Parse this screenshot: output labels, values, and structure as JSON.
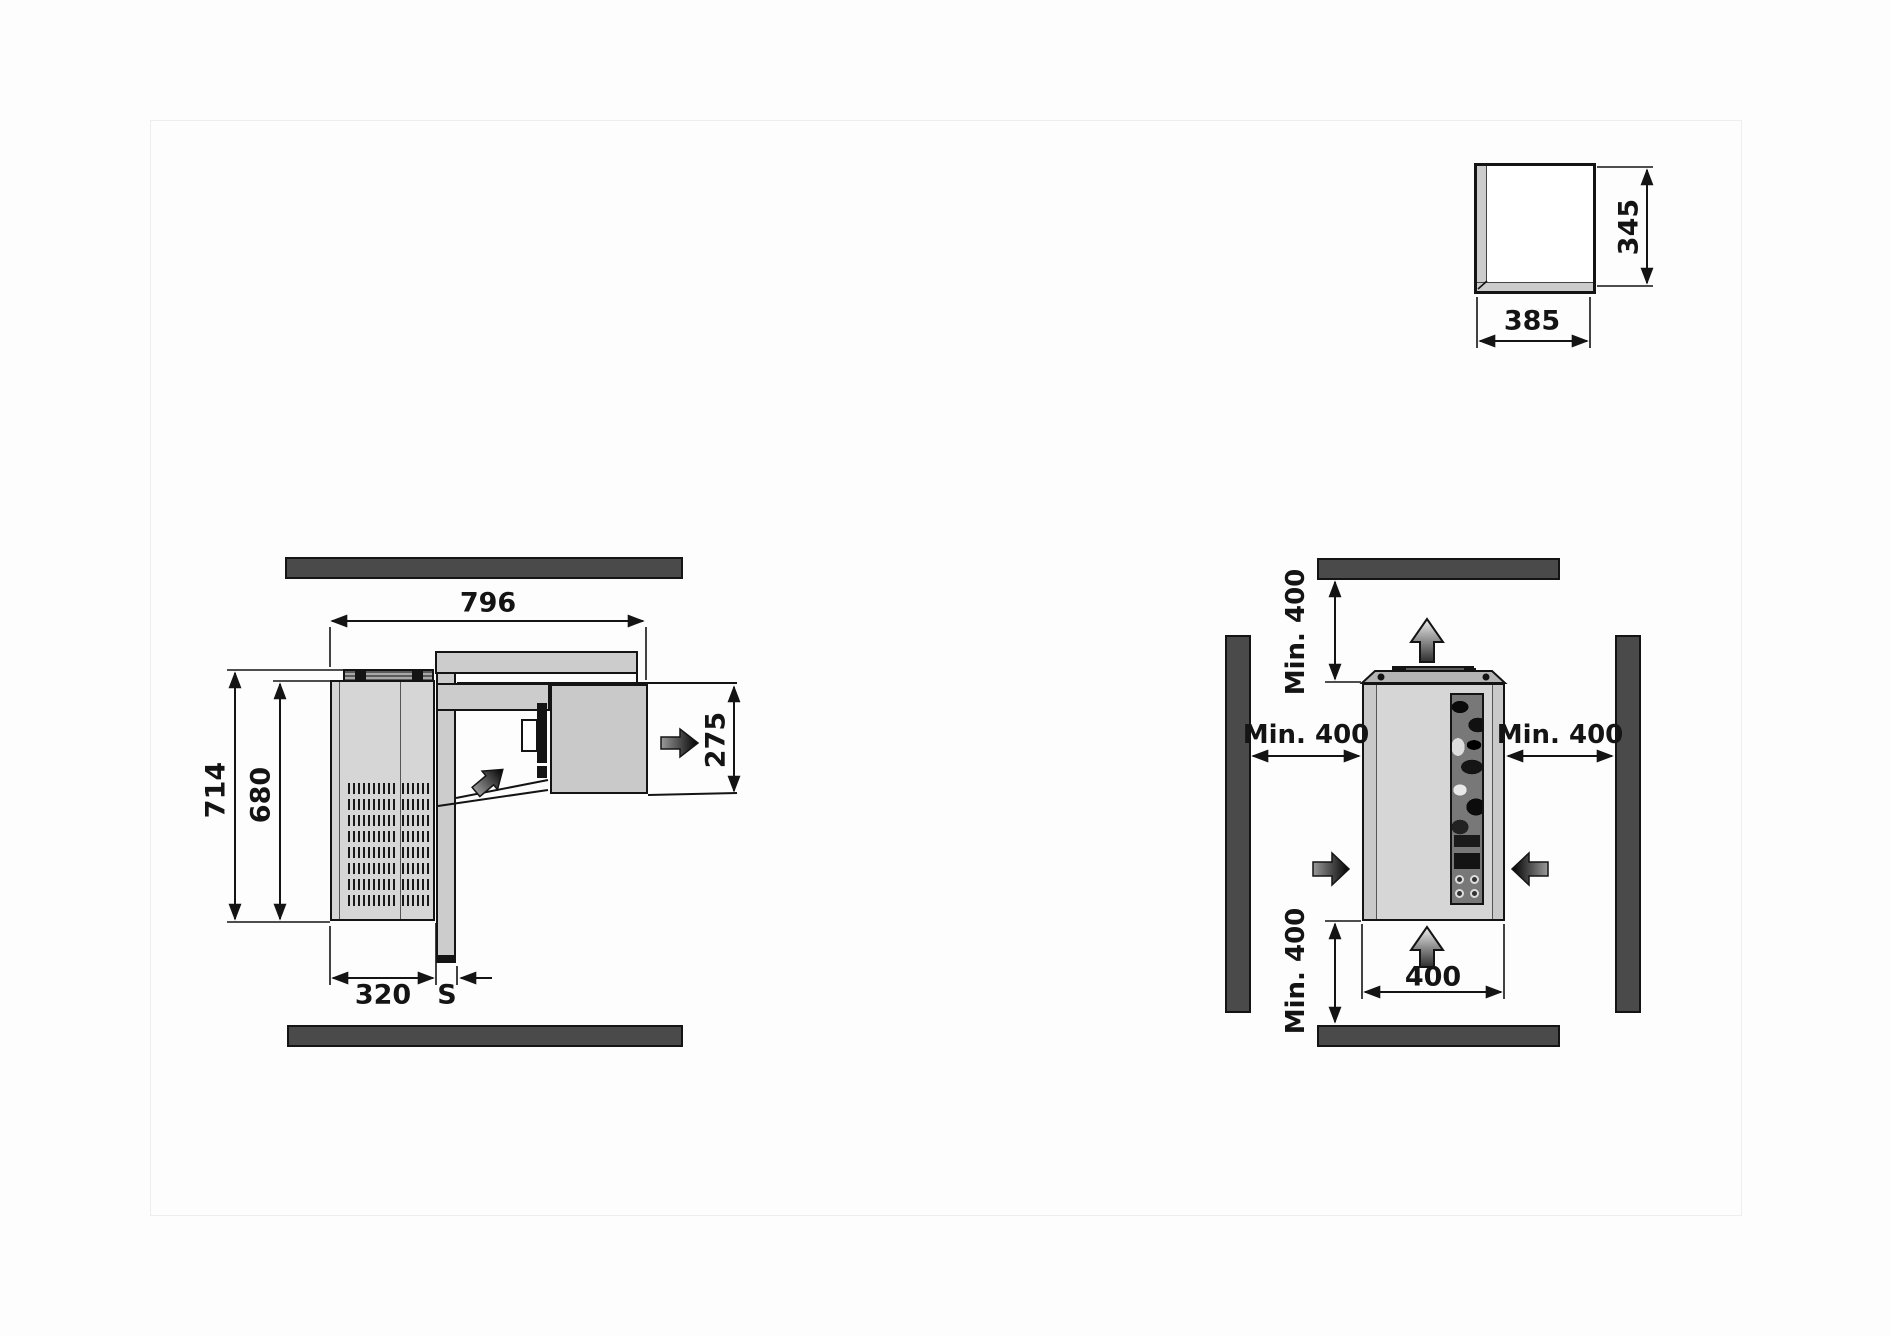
{
  "diagram_title": "monoblock-refrigeration-unit-installation-dimensions",
  "left_view": {
    "dim_width": "796",
    "dim_depth_overall": "714",
    "dim_depth_body": "680",
    "dim_external_projection": "320",
    "dim_wall_thickness": "S",
    "dim_internal_projection": "275"
  },
  "right_view": {
    "dim_clearance_top": "Min. 400",
    "dim_clearance_left": "Min. 400",
    "dim_clearance_right": "Min. 400",
    "dim_clearance_bottom": "Min. 400",
    "dim_unit_width": "400"
  },
  "niche_detail": {
    "dim_width": "385",
    "dim_height": "345"
  },
  "icons": {
    "airflow_out": "right-arrow",
    "airflow_internal": "diagonal-up-right-arrow",
    "exhaust_top": "up-arrow-outline",
    "intake_bottom": "up-arrow-outline",
    "intake_left": "right-arrow",
    "intake_right": "left-arrow"
  },
  "colors": {
    "wall_bar": "#4a4a4a",
    "line": "#141414",
    "unit_fill": "#d6d6d6",
    "panel_fill": "#cccccc",
    "background": "#fdfdfd"
  }
}
